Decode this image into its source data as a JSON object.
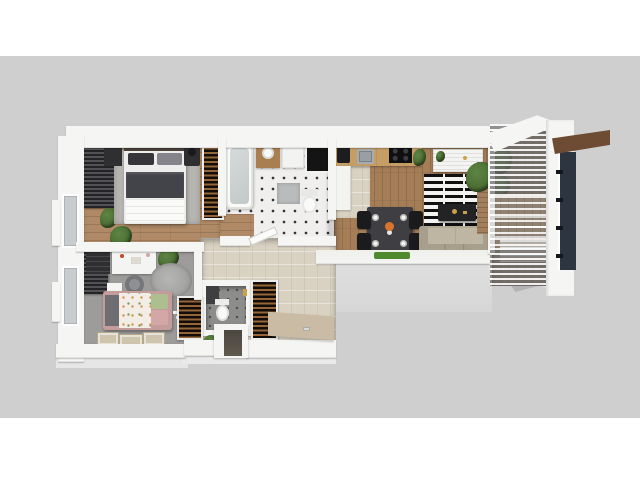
{
  "scene": {
    "type": "3d-floor-plan-render",
    "description": "Photorealistic top-down 3D render of a two-bedroom apartment with a louvered balcony, on a gray backdrop with white bands at top and bottom",
    "text_visible": "none"
  },
  "colors": {
    "page": "#ffffff",
    "bg": "#cfcfcf",
    "wall": "#f5f5f4",
    "facadeDark": "#b3b3b3",
    "woodBedroom": "#b08a66",
    "woodLiving": "#a57e58",
    "woodBalcony": "#8d7a64",
    "counterWood": "#c59e66",
    "backsplash": "#332b24",
    "tileWhite": "#f0efed",
    "tileDot": "#2b2b2b",
    "tileBeige": "#d9d2c3",
    "kidsFloor": "#9d9c9a",
    "wcGray": "#8d8d8b",
    "wcNiche": "#3f3f41",
    "blindDark": "#232326",
    "blindLight": "#515156",
    "stripeDark": "#120d08",
    "stripeTan": "#96653a",
    "rugGray": "#b7b5b1",
    "bedWhite": "#ededeb",
    "duvet": "#43434a",
    "pillowDark": "#35353a",
    "pillowGray": "#84848a",
    "headboard": "#4a4038",
    "furnBlack": "#2f2f31",
    "showerBlack": "#141414",
    "vanityWood": "#a97f52",
    "porcelain": "#fafaf8",
    "matGray": "#b9bcbc",
    "rugStripeBlack": "#101010",
    "rugStripeWhite": "#f2f2f0",
    "coffeeTable": "#232325",
    "gold": "#c9a34a",
    "sofaBase": "#b1a895",
    "sofaBack": "#a79e8b",
    "sofaSeat": "#beb5a2",
    "tableDark": "#3f3f43",
    "chairBlack": "#1b1b1d",
    "plateWhite": "#f5f5f3",
    "centerOrange": "#d8742c",
    "matGreen": "#4f8a2f",
    "applianceWhite": "#f3f3f1",
    "sinkGray": "#99a0a4",
    "stoveBlack": "#0f0f11",
    "plantDark": "#33491f",
    "plantMid": "#4d7035",
    "plantLight": "#5d8544",
    "brick": "#a3805d",
    "navy": "#2c3540",
    "navyTick": "#14171c",
    "roofBrown": "#6e4b33",
    "kidsBedFrame": "#c49c9c",
    "kidsBlanketDark": "#6e6e72",
    "polkaBase": "#f2eee7",
    "pillowGreen": "#aebf8f",
    "pillowPink": "#d4a7a7",
    "matBeige": "#cfc4ae",
    "matBorder": "#b3a78c",
    "deskWhite": "#f4f4f2",
    "chairGray": "#8e9094",
    "glass": "#c7ccce",
    "tanWall": "#c9bba4",
    "doorwayDark": "#60594f"
  },
  "rooms": [
    {
      "id": "master-bedroom",
      "floor": "wood planks",
      "features": [
        "double bed",
        "gray rug",
        "window blinds",
        "open wardrobe",
        "nightstand",
        "plants"
      ]
    },
    {
      "id": "bathroom",
      "floor": "white tile with black dot grid",
      "features": [
        "bathtub",
        "wood vanity with sink",
        "white cabinet",
        "black shower",
        "toilet",
        "bath mat"
      ]
    },
    {
      "id": "kitchen",
      "floor": "wood + beige tile",
      "features": [
        "L-shaped counter",
        "coffee machine",
        "sink",
        "4-burner stove",
        "plant"
      ]
    },
    {
      "id": "dining-area",
      "floor": "wood planks",
      "features": [
        "dark table set with plates",
        "4 black chairs",
        "green mat"
      ]
    },
    {
      "id": "living-room",
      "floor": "wood planks",
      "features": [
        "white sideboard",
        "black-white striped rug",
        "black coffee table",
        "beige sofa",
        "brick feature wall",
        "large plant"
      ]
    },
    {
      "id": "balcony",
      "floor": "wood decking",
      "features": [
        "louvered pergola slats",
        "railing",
        "plants",
        "navy exterior panel",
        "brown roof edge"
      ]
    },
    {
      "id": "kids-bedroom",
      "floor": "gray",
      "features": [
        "desk with chair",
        "dark dresser",
        "wall shelf",
        "round fluffy rug",
        "bed with polka-dot blanket",
        "floor mats",
        "window blinds",
        "plant"
      ]
    },
    {
      "id": "entry-hall",
      "floor": "beige tile",
      "features": [
        "two striped wardrobe cabinets",
        "entrance doorway",
        "plant",
        "tan wall"
      ]
    },
    {
      "id": "wc",
      "floor": "gray tile",
      "features": [
        "toilet",
        "dark niche",
        "gold fixture"
      ]
    }
  ]
}
